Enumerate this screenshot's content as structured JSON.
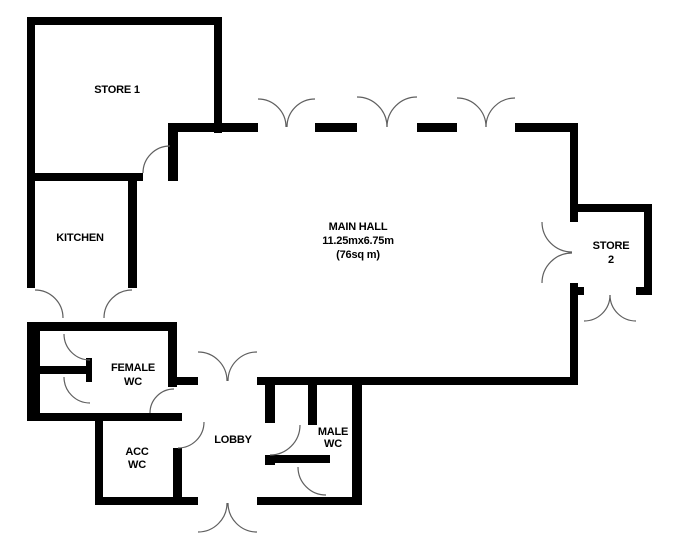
{
  "plan_type": "floor-plan",
  "rooms": [
    {
      "id": "store-1",
      "line1": "STORE 1"
    },
    {
      "id": "kitchen",
      "line1": "KITCHEN"
    },
    {
      "id": "main-hall",
      "line1": "MAIN HALL",
      "line2": "11.25mx6.75m",
      "line3": "(76sq m)"
    },
    {
      "id": "store-2",
      "line1": "STORE",
      "line2": "2"
    },
    {
      "id": "female-wc",
      "line1": "FEMALE",
      "line2": "WC"
    },
    {
      "id": "acc-wc",
      "line1": "ACC",
      "line2": "WC"
    },
    {
      "id": "lobby",
      "line1": "LOBBY"
    },
    {
      "id": "male-wc",
      "line1": "MALE",
      "line2": "WC"
    }
  ],
  "colors": {
    "wall": "#000000",
    "background": "#ffffff",
    "door_arc": "#5f5f5f",
    "text": "#000000"
  }
}
